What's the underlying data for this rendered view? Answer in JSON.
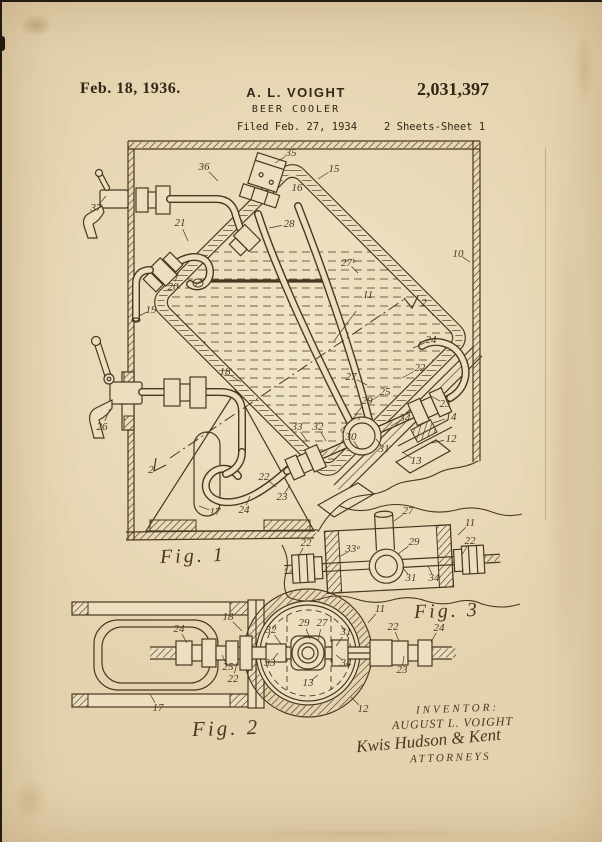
{
  "header": {
    "date": "Feb. 18, 1936.",
    "inventor_name": "A. L. VOIGHT",
    "patent_number": "2,031,397",
    "title": "BEER COOLER",
    "filed": "Filed Feb. 27, 1934",
    "sheet": "2 Sheets-Sheet 1"
  },
  "figures": {
    "fig1": {
      "caption": "Fig. 1"
    },
    "fig2": {
      "caption": "Fig. 2"
    },
    "fig3": {
      "caption": "Fig. 3"
    }
  },
  "signature": {
    "inventor_heading": "INVENTOR:",
    "inventor_name": "AUGUST L. VOIGHT",
    "attorney_signature": "Kwis Hudson & Kent",
    "attorneys_label": "ATTORNEYS"
  },
  "reference_numerals": {
    "fig1": [
      {
        "n": "37",
        "x": 96,
        "y": 211,
        "l": [
          10,
          -12
        ]
      },
      {
        "n": "36",
        "x": 204,
        "y": 170,
        "l": [
          14,
          14
        ]
      },
      {
        "n": "35",
        "x": 291,
        "y": 156,
        "l": [
          -16,
          10
        ]
      },
      {
        "n": "15",
        "x": 334,
        "y": 172,
        "l": [
          -16,
          10
        ]
      },
      {
        "n": "16",
        "x": 297,
        "y": 191
      },
      {
        "n": "28",
        "x": 289,
        "y": 227,
        "l": [
          -20,
          4
        ]
      },
      {
        "n": "21",
        "x": 180,
        "y": 226,
        "l": [
          8,
          18
        ]
      },
      {
        "n": "20",
        "x": 173,
        "y": 290,
        "l": [
          6,
          -16
        ]
      },
      {
        "n": "19",
        "x": 151,
        "y": 313,
        "l": [
          -12,
          6
        ]
      },
      {
        "n": "10",
        "x": 458,
        "y": 257,
        "l": [
          12,
          8
        ]
      },
      {
        "n": "27ᵇ",
        "x": 348,
        "y": 266,
        "l": [
          10,
          10
        ]
      },
      {
        "n": "11",
        "x": 368,
        "y": 298,
        "l": [
          -34,
          46
        ]
      },
      {
        "n": "2",
        "x": 424,
        "y": 306
      },
      {
        "n": "2",
        "x": 151,
        "y": 473
      },
      {
        "n": "26",
        "x": 102,
        "y": 430,
        "l": [
          8,
          -18
        ]
      },
      {
        "n": "18",
        "x": 225,
        "y": 375,
        "l": [
          16,
          10
        ]
      },
      {
        "n": "27",
        "x": 351,
        "y": 380,
        "l": [
          16,
          8
        ]
      },
      {
        "n": "25",
        "x": 385,
        "y": 395,
        "l": [
          -16,
          10
        ]
      },
      {
        "n": "29",
        "x": 367,
        "y": 404,
        "l": [
          -12,
          14
        ]
      },
      {
        "n": "24",
        "x": 431,
        "y": 343,
        "l": [
          -18,
          8
        ]
      },
      {
        "n": "22",
        "x": 420,
        "y": 371,
        "l": [
          -18,
          10
        ]
      },
      {
        "n": "23",
        "x": 445,
        "y": 407,
        "l": [
          -14,
          -8
        ]
      },
      {
        "n": "34",
        "x": 405,
        "y": 421,
        "l": [
          -14,
          8
        ]
      },
      {
        "n": "30",
        "x": 351,
        "y": 440,
        "l": [
          8,
          12
        ]
      },
      {
        "n": "31",
        "x": 384,
        "y": 452,
        "l": [
          -8,
          -10
        ]
      },
      {
        "n": "33",
        "x": 297,
        "y": 430,
        "l": [
          10,
          14
        ]
      },
      {
        "n": "32",
        "x": 318,
        "y": 430,
        "l": [
          8,
          14
        ]
      },
      {
        "n": "22",
        "x": 264,
        "y": 480,
        "l": [
          12,
          10
        ]
      },
      {
        "n": "23",
        "x": 282,
        "y": 500,
        "l": [
          8,
          -12
        ]
      },
      {
        "n": "24",
        "x": 244,
        "y": 513,
        "l": [
          6,
          -14
        ]
      },
      {
        "n": "17",
        "x": 215,
        "y": 515,
        "l": [
          -16,
          -6
        ]
      },
      {
        "n": "14",
        "x": 451,
        "y": 420,
        "l": [
          -18,
          6
        ]
      },
      {
        "n": "12",
        "x": 451,
        "y": 442,
        "l": [
          -20,
          4
        ]
      },
      {
        "n": "13",
        "x": 416,
        "y": 464,
        "l": [
          -12,
          -8
        ]
      }
    ],
    "fig3": [
      {
        "n": "27",
        "x": 408,
        "y": 514,
        "l": [
          -14,
          10
        ]
      },
      {
        "n": "11",
        "x": 470,
        "y": 526,
        "l": [
          -12,
          12
        ]
      },
      {
        "n": "22",
        "x": 306,
        "y": 546,
        "l": [
          -8,
          14
        ]
      },
      {
        "n": "33ᵃ",
        "x": 353,
        "y": 552,
        "l": [
          -14,
          8
        ]
      },
      {
        "n": "29",
        "x": 414,
        "y": 545,
        "l": [
          -16,
          12
        ]
      },
      {
        "n": "22",
        "x": 470,
        "y": 544,
        "l": [
          -8,
          14
        ]
      },
      {
        "n": "31",
        "x": 411,
        "y": 581,
        "l": [
          -8,
          -10
        ]
      },
      {
        "n": "34",
        "x": 434,
        "y": 581,
        "l": [
          -6,
          -12
        ]
      }
    ],
    "fig2": [
      {
        "n": "18",
        "x": 228,
        "y": 620,
        "l": [
          14,
          14
        ]
      },
      {
        "n": "24",
        "x": 179,
        "y": 632,
        "l": [
          8,
          14
        ]
      },
      {
        "n": "25",
        "x": 228,
        "y": 670,
        "l": [
          -6,
          -12
        ]
      },
      {
        "n": "22",
        "x": 233,
        "y": 682,
        "l": [
          4,
          -16
        ]
      },
      {
        "n": "32",
        "x": 271,
        "y": 633,
        "l": [
          10,
          14
        ]
      },
      {
        "n": "33",
        "x": 270,
        "y": 666,
        "l": [
          8,
          -10
        ]
      },
      {
        "n": "29",
        "x": 304,
        "y": 626,
        "l": [
          6,
          16
        ]
      },
      {
        "n": "27",
        "x": 322,
        "y": 626,
        "l": [
          -4,
          18
        ]
      },
      {
        "n": "31",
        "x": 346,
        "y": 635,
        "l": [
          -10,
          14
        ]
      },
      {
        "n": "34",
        "x": 346,
        "y": 666,
        "l": [
          -10,
          -8
        ]
      },
      {
        "n": "13",
        "x": 308,
        "y": 686,
        "l": [
          10,
          -8
        ]
      },
      {
        "n": "11",
        "x": 380,
        "y": 612,
        "l": [
          -12,
          14
        ]
      },
      {
        "n": "22",
        "x": 393,
        "y": 630,
        "l": [
          6,
          14
        ]
      },
      {
        "n": "24",
        "x": 439,
        "y": 631,
        "l": [
          -8,
          14
        ]
      },
      {
        "n": "23",
        "x": 402,
        "y": 673,
        "l": [
          2,
          -14
        ]
      },
      {
        "n": "12",
        "x": 363,
        "y": 712,
        "l": [
          -12,
          -12
        ]
      },
      {
        "n": "17",
        "x": 158,
        "y": 711,
        "l": [
          -8,
          -14
        ]
      }
    ]
  },
  "colors": {
    "paper": "#e4d3ae",
    "paper2": "#ecdfc0",
    "ink": "#4a3722",
    "ink2": "#332718"
  }
}
